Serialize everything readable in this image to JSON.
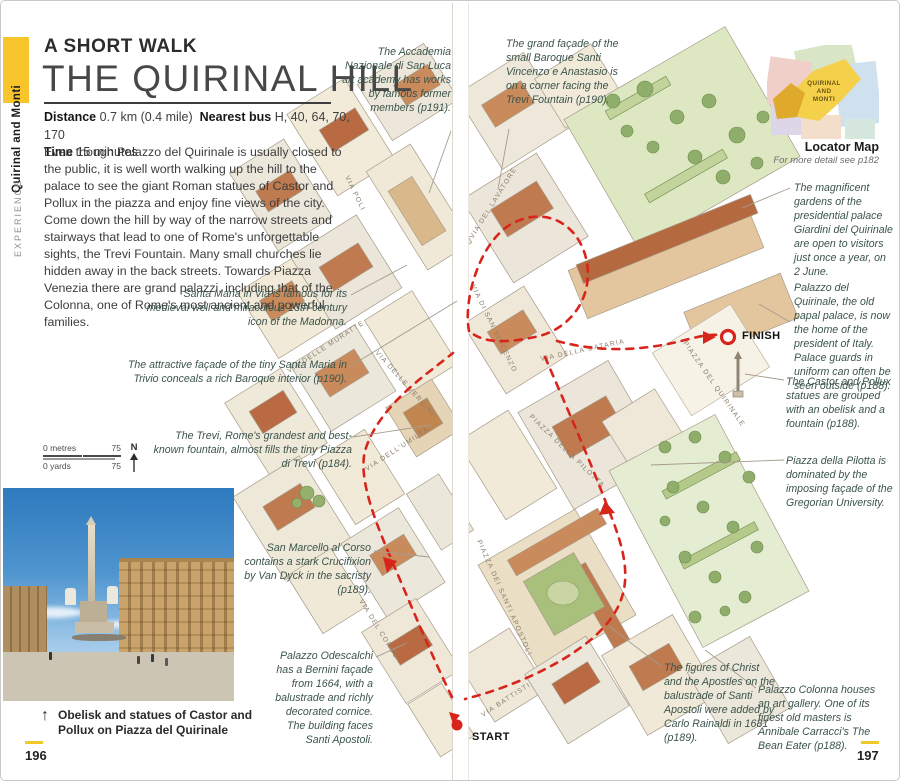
{
  "header": {
    "kicker": "A SHORT WALK",
    "title": "THE QUIRINAL HILL"
  },
  "side_tab": {
    "section": "EXPERIENCE",
    "area": "Quirinal and Monti"
  },
  "meta": {
    "distance_label": "Distance",
    "distance_value": "0.7 km (0.4 mile)",
    "bus_label": "Nearest bus",
    "bus_value": "H, 40, 64, 70, 170",
    "time_label": "Time",
    "time_value": "15 minutes"
  },
  "intro": "Even though Palazzo del Quirinale is usually closed to the public, it is well worth walking up the hill to the palace to see the giant Roman statues of Castor and Pollux in the piazza and enjoy fine views of the city. Come down the hill by way of the narrow streets and stairways that lead to one of Rome's unforgettable sights, the Trevi Fountain. Many small churches lie hidden away in the back streets. Towards Piazza Venezia there are grand palazzi, including that of the Colonna, one of Rome's most ancient and powerful families.",
  "scale_bar": {
    "metres_label": "0 metres",
    "metres_max": "75",
    "yards_label": "0 yards",
    "yards_max": "75",
    "north": "N"
  },
  "photo_caption": "Obelisk and statues of Castor and Pollux on Piazza del Quirinale",
  "page_numbers": {
    "left": "196",
    "right": "197"
  },
  "locator": {
    "line1": "QUIRINAL",
    "line2": "AND",
    "line3": "MONTI",
    "title": "Locator Map",
    "subtitle": "For more detail see p182"
  },
  "route": {
    "start": "START",
    "finish": "FINISH"
  },
  "streets": [
    "VIA POLI",
    "VIA DEL LAVATORE",
    "VIA DELLE MURATTE",
    "VIA DELLE VERGINI",
    "VIA DELL'UMILTÀ",
    "VIA DI SAN VINCENZO",
    "VIA DELLA DATARIA",
    "PIAZZA DEL QUIRINALE",
    "PIAZZA DELLA PILOTTA",
    "VIA DEL CORSO",
    "PIAZZA DEI SANTI APOSTOLI",
    "VIA BATTISTI"
  ],
  "annotations": [
    "The Accademia Nazionale di San Luca art academy has works by famous former members (p191).",
    "The grand façade of the small Baroque Santi Vincenzo e Anastasio is on a corner facing the Trevi Fountain (p190).",
    "Santa Maria in Via is famous for its medieval well and miraculous 13th-century icon of the Madonna.",
    "The attractive façade of the tiny Santa Maria in Trivio conceals a rich Baroque interior (p190).",
    "The Trevi, Rome's grandest and best-known fountain, almost fills the tiny Piazza di Trevi (p184).",
    "San Marcello al Corso contains a stark Crucifixion by Van Dyck in the sacristy (p189).",
    "Palazzo Odescalchi has a Bernini façade from 1664, with a balustrade and richly decorated cornice. The building faces Santi Apostoli.",
    "The magnificent gardens of the presidential palace Giardini del Quirinale are open to visitors just once a year, on 2 June.",
    "Palazzo del Quirinale, the old papal palace, is now the home of the president of Italy. Palace guards in uniform can often be seen outside (p188).",
    "The Castor and Pollux statues are grouped with an obelisk and a fountain (p188).",
    "Piazza della Pilotta is dominated by the imposing façade of the Gregorian University.",
    "The figures of Christ and the Apostles on the balustrade of Santi Apostoli were added by Carlo Rainaldi in 1681 (p189).",
    "Palazzo Colonna houses an art gallery. One of its finest old masters is Annibale Carracci's The Bean Eater (p188)."
  ],
  "colors": {
    "accent_yellow": "#f8c62c",
    "route_red": "#d8251c"
  }
}
